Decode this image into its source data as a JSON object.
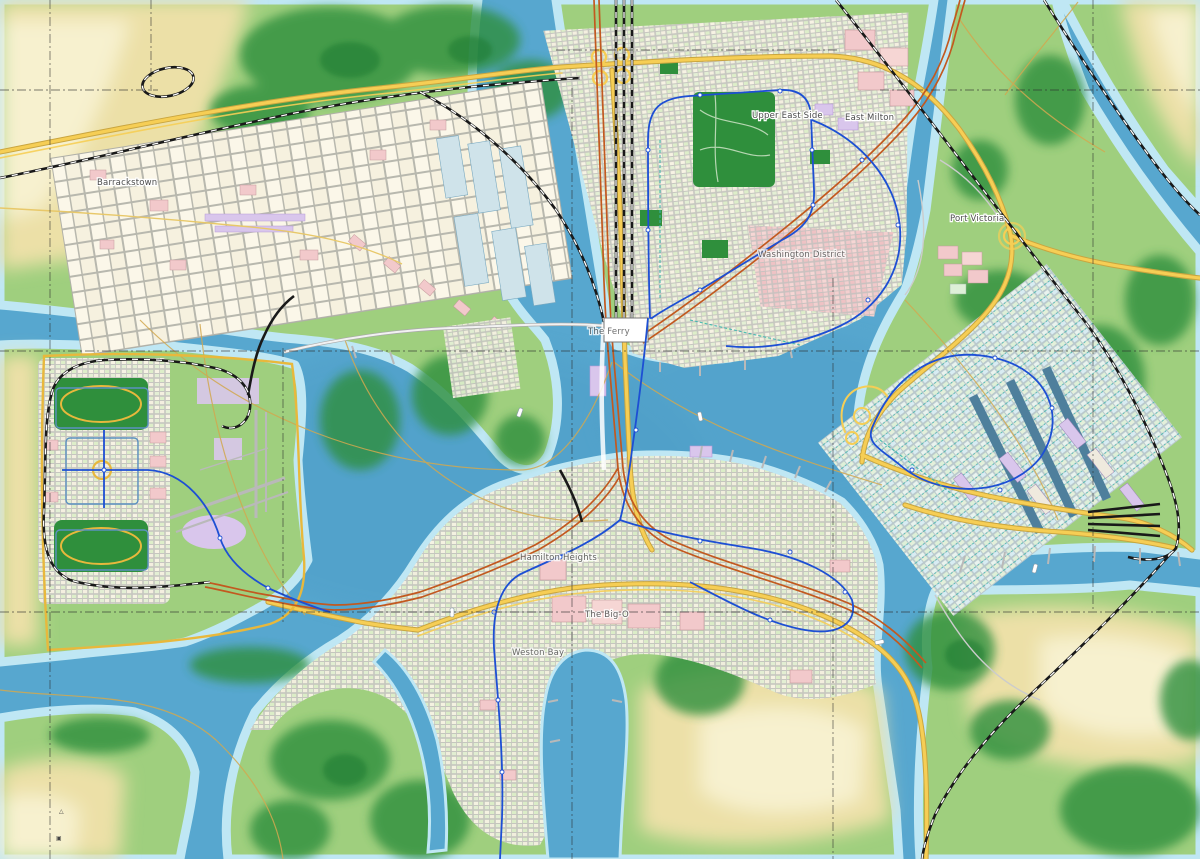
{
  "map": {
    "type": "city-transport-map",
    "labels": [
      {
        "text": "Barrackstown",
        "x": 97,
        "y": 185
      },
      {
        "text": "Upper East Side",
        "x": 752,
        "y": 118
      },
      {
        "text": "East Milton",
        "x": 845,
        "y": 120
      },
      {
        "text": "Washington District",
        "x": 758,
        "y": 257
      },
      {
        "text": "Port Victoria",
        "x": 950,
        "y": 221
      },
      {
        "text": "Hamilton Heights",
        "x": 520,
        "y": 560
      },
      {
        "text": "The Big-O",
        "x": 585,
        "y": 617
      },
      {
        "text": "Weston Bay",
        "x": 512,
        "y": 655
      },
      {
        "text": "The Ferry",
        "x": 588,
        "y": 334
      }
    ],
    "markers": [
      {
        "glyph": "△",
        "x": 59,
        "y": 813
      },
      {
        "glyph": "▣",
        "x": 56,
        "y": 840
      }
    ],
    "colors": {
      "water": "#57a7cf",
      "shallow_rim": "#bfe7f4",
      "land": "#9fcf7e",
      "forest": "#2e8f3e",
      "sand": "#ece0a7",
      "sand_light": "#f7f1cf",
      "park": "#2f8f3c",
      "highway_yellow": "#f6ce55",
      "highway_casing": "#c9a53f",
      "arterial_orange": "#c2591f",
      "rail_black": "#191919",
      "metro_blue": "#1d4fd4",
      "transit_teal": "#3ab5ad",
      "street_blue": "#5b90c0",
      "ship_line": "#d2a84f",
      "block_cream": "#f7f3e4",
      "block_pink": "#f2c9cb",
      "block_purple": "#d9c6ec",
      "block_green": "#ddeec9",
      "dock_water": "#4e7f9c",
      "grid_line": "#2b2b2b"
    }
  }
}
